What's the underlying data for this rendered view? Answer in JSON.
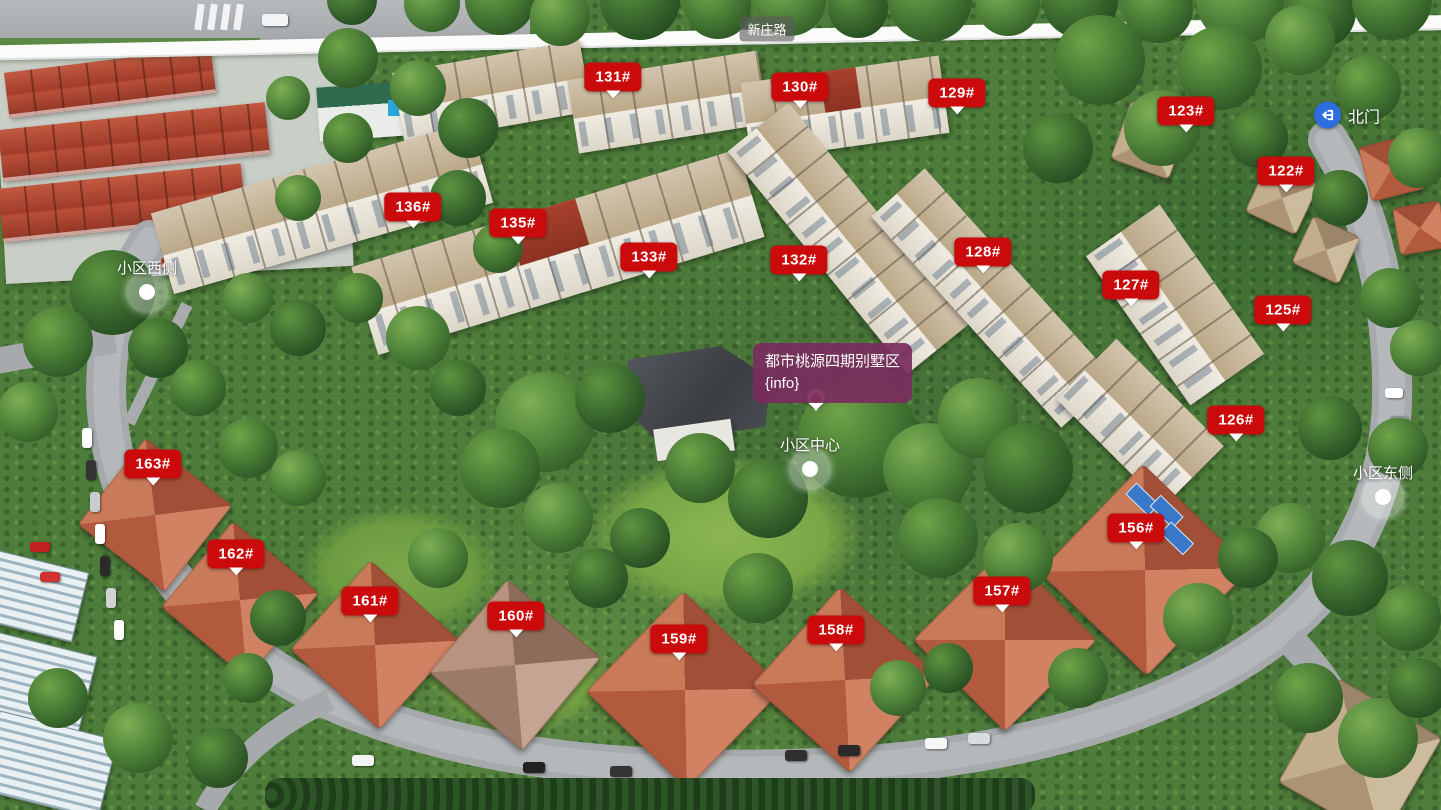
{
  "colors": {
    "badge_red": "#cb0a0c",
    "tooltip_purple": "rgba(122,44,93,0.92)",
    "gate_blue": "#2e6de0",
    "pin_orange": "#ed6a1e"
  },
  "road_label": {
    "text": "新庄路",
    "x": 767,
    "y": 29
  },
  "gate": {
    "label": "北门",
    "icon": "entry-arrow-icon",
    "x": 1314,
    "y": 115
  },
  "tooltip": {
    "line1": "都市桃源四期别墅区",
    "line2": "{info}",
    "x": 753,
    "y": 343,
    "pin_x": 816,
    "pin_y": 398
  },
  "hotspots": [
    {
      "label": "小区西侧",
      "x": 147,
      "y": 292
    },
    {
      "label": "小区中心",
      "x": 810,
      "y": 469
    },
    {
      "label": "小区东侧",
      "x": 1383,
      "y": 497
    }
  ],
  "buildings": [
    {
      "label": "131#",
      "x": 613,
      "y": 77
    },
    {
      "label": "130#",
      "x": 800,
      "y": 87
    },
    {
      "label": "129#",
      "x": 957,
      "y": 93
    },
    {
      "label": "123#",
      "x": 1186,
      "y": 111
    },
    {
      "label": "122#",
      "x": 1286,
      "y": 171
    },
    {
      "label": "136#",
      "x": 413,
      "y": 207
    },
    {
      "label": "135#",
      "x": 518,
      "y": 223
    },
    {
      "label": "133#",
      "x": 649,
      "y": 257
    },
    {
      "label": "132#",
      "x": 799,
      "y": 260
    },
    {
      "label": "128#",
      "x": 983,
      "y": 252
    },
    {
      "label": "127#",
      "x": 1131,
      "y": 285
    },
    {
      "label": "125#",
      "x": 1283,
      "y": 310
    },
    {
      "label": "126#",
      "x": 1236,
      "y": 420
    },
    {
      "label": "163#",
      "x": 153,
      "y": 464
    },
    {
      "label": "162#",
      "x": 236,
      "y": 554
    },
    {
      "label": "161#",
      "x": 370,
      "y": 601
    },
    {
      "label": "160#",
      "x": 516,
      "y": 616
    },
    {
      "label": "159#",
      "x": 679,
      "y": 639
    },
    {
      "label": "158#",
      "x": 836,
      "y": 630
    },
    {
      "label": "157#",
      "x": 1002,
      "y": 591
    },
    {
      "label": "156#",
      "x": 1136,
      "y": 528
    }
  ]
}
